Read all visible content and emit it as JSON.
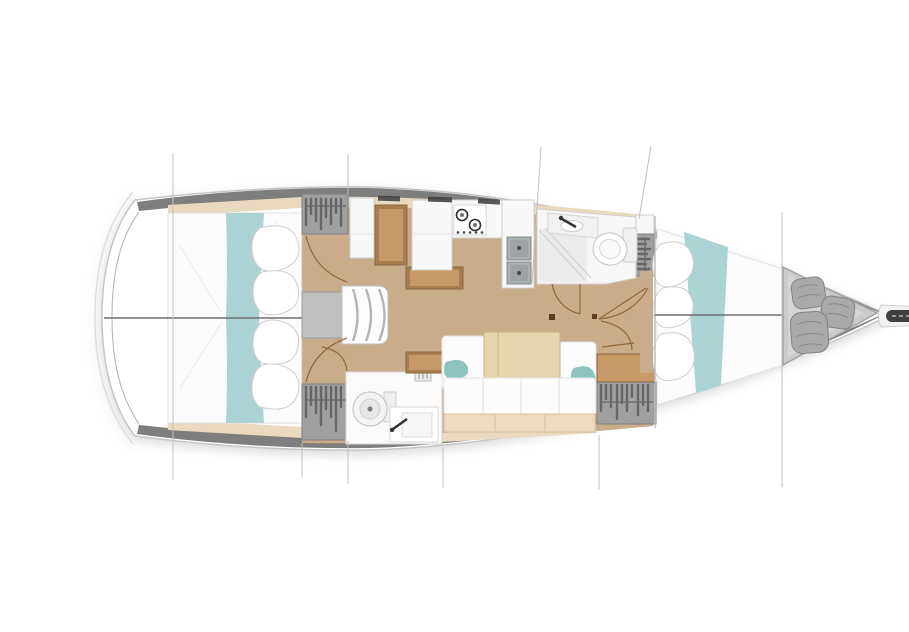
{
  "title": "Sailing yacht interior layout plan — top-down deck drawing, bow pointing right",
  "plan": {
    "rooms": [
      {
        "id": "aft-cabin-port",
        "label": "Aft double cabin (top/port) with white berth, teal runner and pillows"
      },
      {
        "id": "aft-cabin-starboard",
        "label": "Aft double cabin (bottom/starboard) with white berth, teal runner and pillows"
      },
      {
        "id": "companionway",
        "label": "Companionway steps with engine box"
      },
      {
        "id": "nav-station",
        "label": "Chart table with seat"
      },
      {
        "id": "galley",
        "label": "Galley with two-burner stove and double sink"
      },
      {
        "id": "head-forward",
        "label": "Forward head with shower, washbasin and toilet"
      },
      {
        "id": "head-aft",
        "label": "Aft head with toilet and washbasin"
      },
      {
        "id": "saloon",
        "label": "Saloon with L-settee, teal cushions and folding table"
      },
      {
        "id": "wardrobes",
        "label": "Hanging lockers with clothes"
      },
      {
        "id": "forward-cabin",
        "label": "Forward V-berth cabin with teal runner and pillows"
      },
      {
        "id": "sail-locker",
        "label": "Forepeak sail locker with three fenders"
      },
      {
        "id": "bowsprit",
        "label": "Bowsprit with anchor roller"
      }
    ],
    "construction_lines": "thin vertical station lines above and below the hull"
  },
  "colors": {
    "hull_band": "#7e7e7e",
    "hull_outline": "#c6c6c6",
    "hull_outer_line": "#dedede",
    "white_furniture": "#f8f8f8",
    "bed_white": "#fcfcfc",
    "stroke_light": "#cfcfcf",
    "stroke_lighter": "#e2e2e2",
    "wood_floor": "#c9ac89",
    "side_deck": "#e9d9be",
    "teal": "#abd3d3",
    "teal_pillow": "#8fc3bf",
    "furniture_wood": "#a87e50",
    "furniture_wood_light": "#c59a68",
    "furniture_wood_dark": "#8a6642",
    "table_wood": "#e7d4af",
    "table_wood_edge": "#ccb183",
    "bench_wood": "#eddcc0",
    "bench_wood_edge": "#d2c19c",
    "locker_grey": "#a0a0a0",
    "locker_stripe": "#666666",
    "locker_edge": "#7f7f7f",
    "fixture_grey": "#bfbfbf",
    "sink_grey": "#aab0b2",
    "sink_edge": "#83898c",
    "dark_metal": "#3f3f3f",
    "door_arc": "#8a5a2e",
    "construction_line": "#c0c0c0",
    "centerline": "#6f6f6f",
    "forepeak_grey": "#cbcbcb",
    "forepeak_edge": "#a3a3a3",
    "fender_grey": "#a9a9a9",
    "fender_edge": "#838383",
    "shower_floor": "#ececec"
  }
}
